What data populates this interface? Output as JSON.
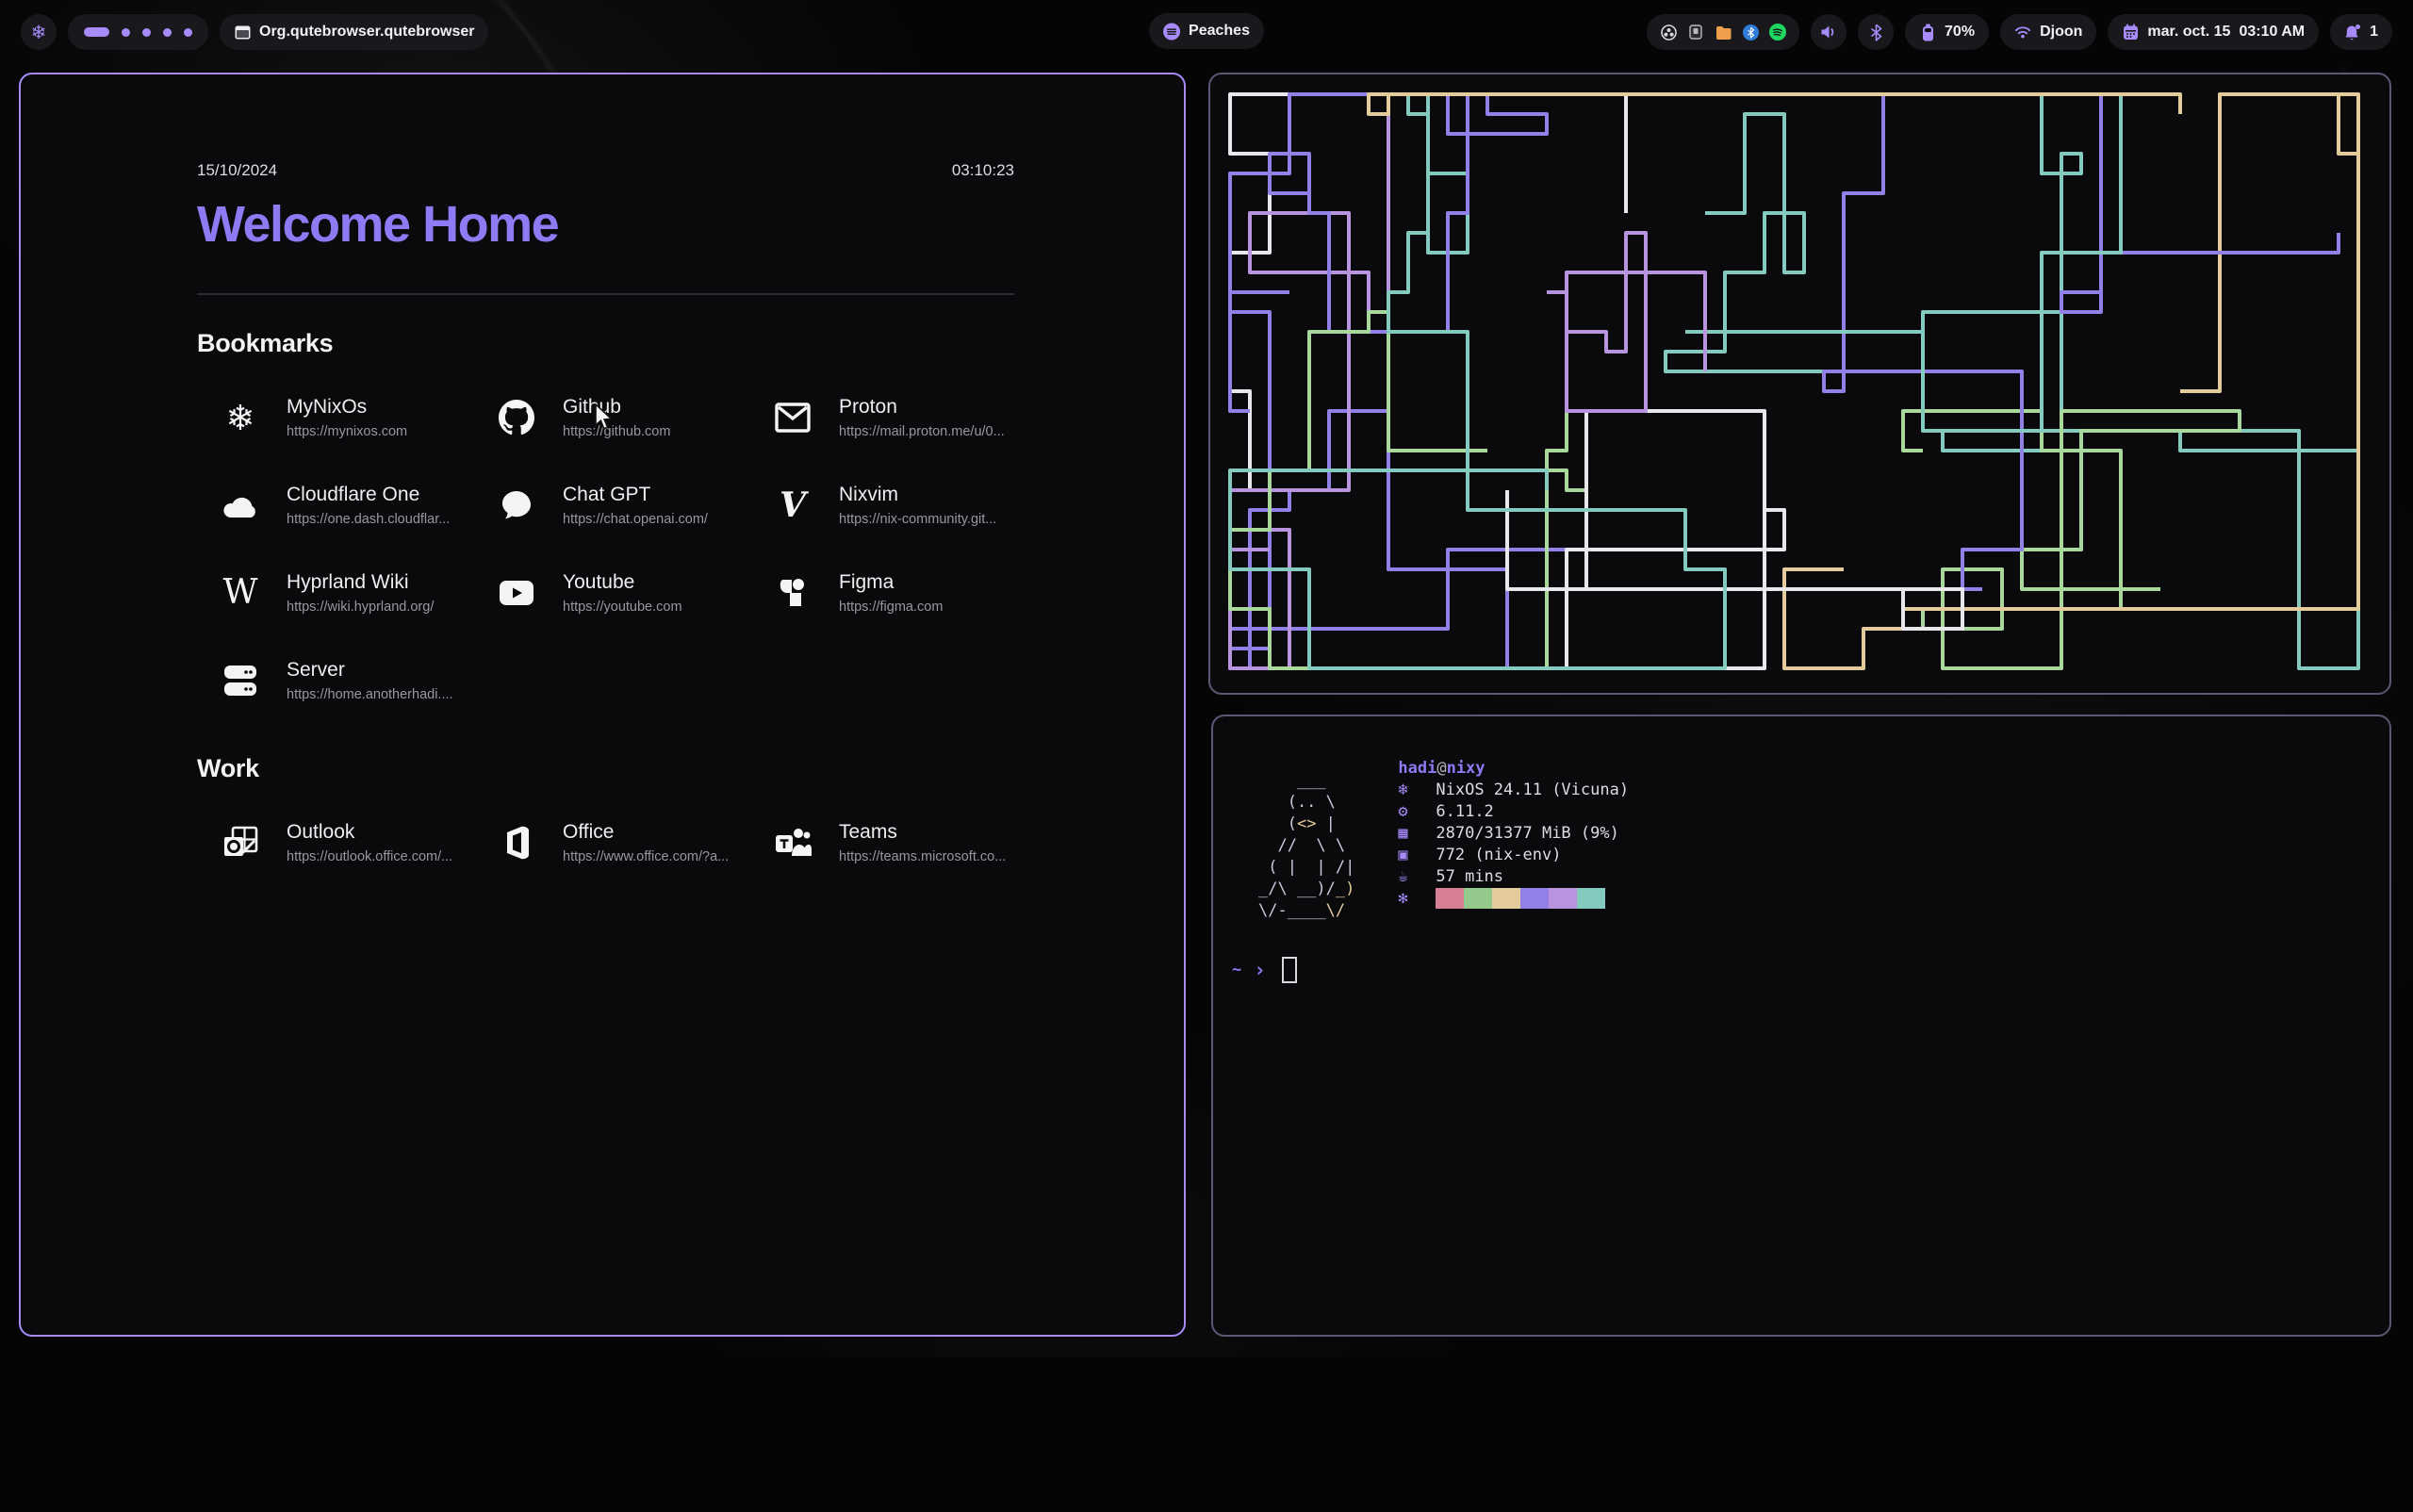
{
  "colors": {
    "accent": "#a78bfa",
    "startpage_title": "#8d7bf4",
    "active_border": "#a78bfa",
    "inactive_border": "#575a72",
    "url_text": "#97979e"
  },
  "bar": {
    "launcher_icon": "nix-snowflake",
    "workspaces": {
      "active_index": 0,
      "count": 5
    },
    "window_title": "Org.qutebrowser.qutebrowser",
    "media": {
      "label": "Peaches"
    },
    "tray_icons": [
      "obs",
      "kdeconnect",
      "files",
      "bluetooth",
      "spotify"
    ],
    "battery": {
      "percent": "70%"
    },
    "network": {
      "ssid": "Djoon"
    },
    "clock": {
      "date": "mar. oct. 15",
      "time": "03:10 AM"
    },
    "notifications": {
      "count": "1"
    }
  },
  "startpage": {
    "date": "15/10/2024",
    "time": "03:10:23",
    "title": "Welcome Home",
    "sections": [
      {
        "heading": "Bookmarks",
        "items": [
          {
            "label": "MyNixOs",
            "url": "https://mynixos.com",
            "icon": "nix-snowflake"
          },
          {
            "label": "Github",
            "url": "https://github.com",
            "icon": "github"
          },
          {
            "label": "Proton",
            "url": "https://mail.proton.me/u/0...",
            "icon": "mail-envelope"
          },
          {
            "label": "Cloudflare One",
            "url": "https://one.dash.cloudflar...",
            "icon": "cloud"
          },
          {
            "label": "Chat GPT",
            "url": "https://chat.openai.com/",
            "icon": "chat-bubble"
          },
          {
            "label": "Nixvim",
            "url": "https://nix-community.git...",
            "icon": "nixvim-v"
          },
          {
            "label": "Hyprland Wiki",
            "url": "https://wiki.hyprland.org/",
            "icon": "wikipedia-w"
          },
          {
            "label": "Youtube",
            "url": "https://youtube.com",
            "icon": "youtube-play"
          },
          {
            "label": "Figma",
            "url": "https://figma.com",
            "icon": "figma"
          },
          {
            "label": "Server",
            "url": "https://home.anotherhadi....",
            "icon": "server-stack"
          }
        ]
      },
      {
        "heading": "Work",
        "items": [
          {
            "label": "Outlook",
            "url": "https://outlook.office.com/...",
            "icon": "outlook"
          },
          {
            "label": "Office",
            "url": "https://www.office.com/?a...",
            "icon": "office"
          },
          {
            "label": "Teams",
            "url": "https://teams.microsoft.co...",
            "icon": "teams"
          }
        ]
      }
    ]
  },
  "terminal": {
    "fetch": {
      "user": "hadi",
      "at": "@",
      "host": "nixy",
      "art_colors": {
        "f": "#c6cade",
        "y": "#e3cb9c"
      },
      "art": [
        [
          [
            "    ___",
            "f"
          ]
        ],
        [
          [
            "   (.. \\",
            "f"
          ]
        ],
        [
          [
            "   (",
            "f"
          ],
          [
            "<>",
            "y"
          ],
          [
            " |",
            "f"
          ]
        ],
        [
          [
            "  //  \\ \\",
            "f"
          ]
        ],
        [
          [
            " ( |  | /|",
            "f"
          ]
        ],
        [
          [
            "_/\\ __)/",
            "f"
          ],
          [
            "_)",
            "y"
          ]
        ],
        [
          [
            "\\/-____",
            "f"
          ],
          [
            "\\/",
            "y"
          ]
        ]
      ],
      "info": [
        {
          "icon": "❄",
          "text": "NixOS 24.11 (Vicuna)",
          "field": "os"
        },
        {
          "icon": "⚙",
          "text": "6.11.2",
          "field": "kernel"
        },
        {
          "icon": "▦",
          "text": "2870/31377 MiB (9%)",
          "field": "memory"
        },
        {
          "icon": "▣",
          "text": "772 (nix-env)",
          "field": "packages"
        },
        {
          "icon": "☕",
          "text": "57 mins",
          "field": "uptime"
        }
      ],
      "palette_icon": "✻",
      "palette": [
        "#d77f95",
        "#93c98b",
        "#e3cb9c",
        "#9180e6",
        "#b794dd",
        "#84cabf"
      ]
    },
    "prompt": {
      "cwd": "~",
      "symbol": "›"
    }
  },
  "pipes": {
    "seed": 20,
    "cell": 21,
    "stroke": 4,
    "count": 15,
    "min_len": 45,
    "max_len": 120,
    "turn_chance": 0.18,
    "colors": [
      "#84cabf",
      "#9180e6",
      "#a8d89c",
      "#e8e8ec",
      "#e3cb9c",
      "#84cabf",
      "#b794dd",
      "#9180e6"
    ]
  }
}
